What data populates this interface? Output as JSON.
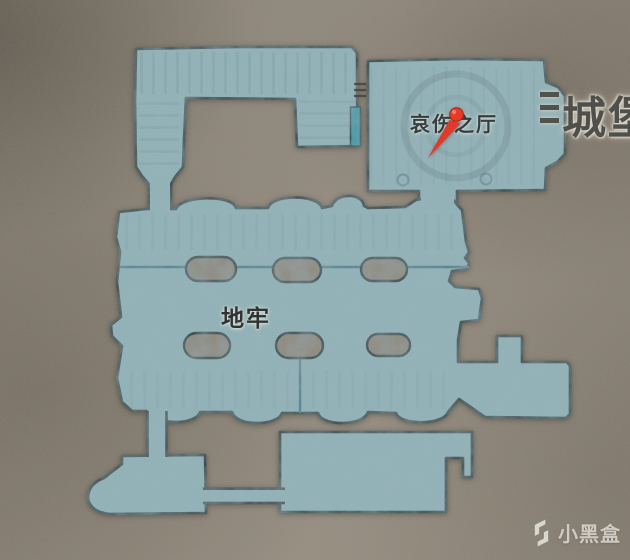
{
  "map": {
    "region_labels": {
      "hall_of_sorrow": "哀伤之厅",
      "dungeon": "地牢",
      "castle_partial": "城堡"
    },
    "marker": {
      "name": "red-location-pin",
      "color": "#e5301f"
    },
    "door": {
      "name": "teal-door-bar",
      "color": "#3a96a6"
    },
    "colors": {
      "background": "#8b8377",
      "map_fill": "#8fb3ba",
      "map_outline": "#2a3539",
      "detail_line": "#4e7c8a"
    }
  },
  "watermark": {
    "brand": "小黑盒",
    "icon": "heybox-logo",
    "color": "#d8d4cd"
  }
}
